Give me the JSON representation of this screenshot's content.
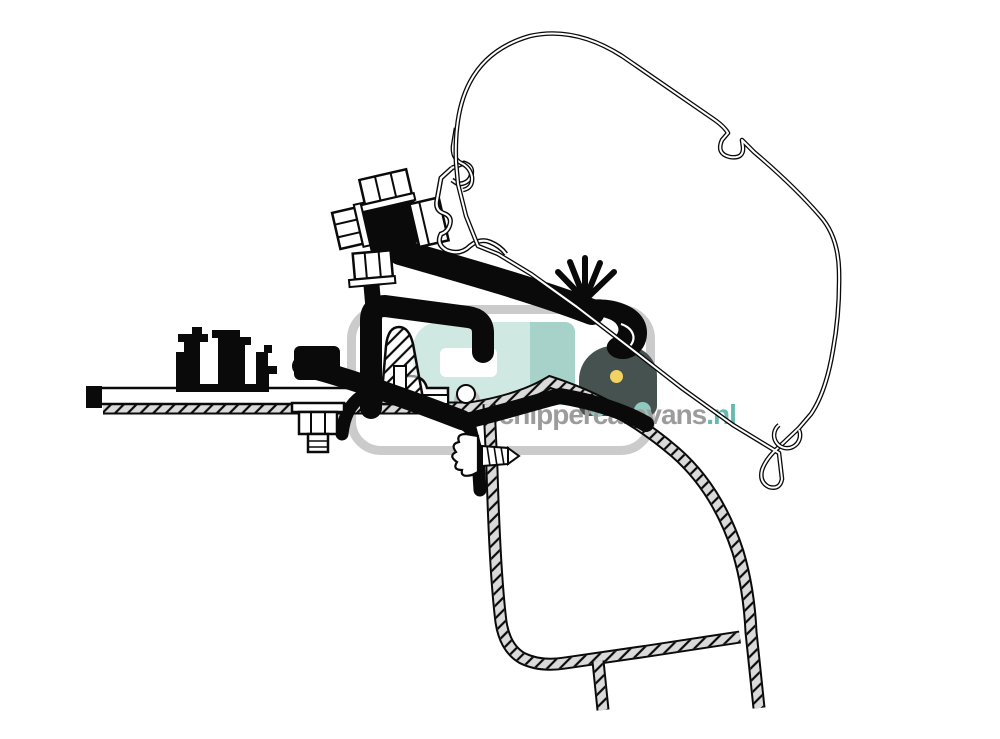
{
  "watermark": {
    "brand": "Schippercaravans",
    "tld": ".nl",
    "colors": {
      "frame": "#cbcbcb",
      "caravan": "#cfe8e2",
      "caravan_shade": "#a6d2c9",
      "car": "#46524f",
      "headlight": "#f2d261",
      "wheel": "#8fc9c0",
      "text": "#9c9c9c",
      "tld": "#68bab0"
    }
  },
  "diagram": {
    "ink": "#0a0a0a",
    "background": "#ffffff",
    "parts": [
      "awning-case-profile",
      "case-rafter-hook",
      "case-end-hook",
      "lead-rail-profile",
      "mounting-bracket",
      "bracket-clamp-block",
      "hex-bolts",
      "clamp-nut",
      "spring-clip",
      "rail-hook",
      "bracket-base",
      "roof-rail-profile",
      "base-plate",
      "roof-bolt",
      "self-tapping-screw",
      "fastener-clip",
      "adapter-wedge-section",
      "vehicle-roof-panel",
      "vehicle-outer-wall",
      "vehicle-inner-wall"
    ]
  }
}
